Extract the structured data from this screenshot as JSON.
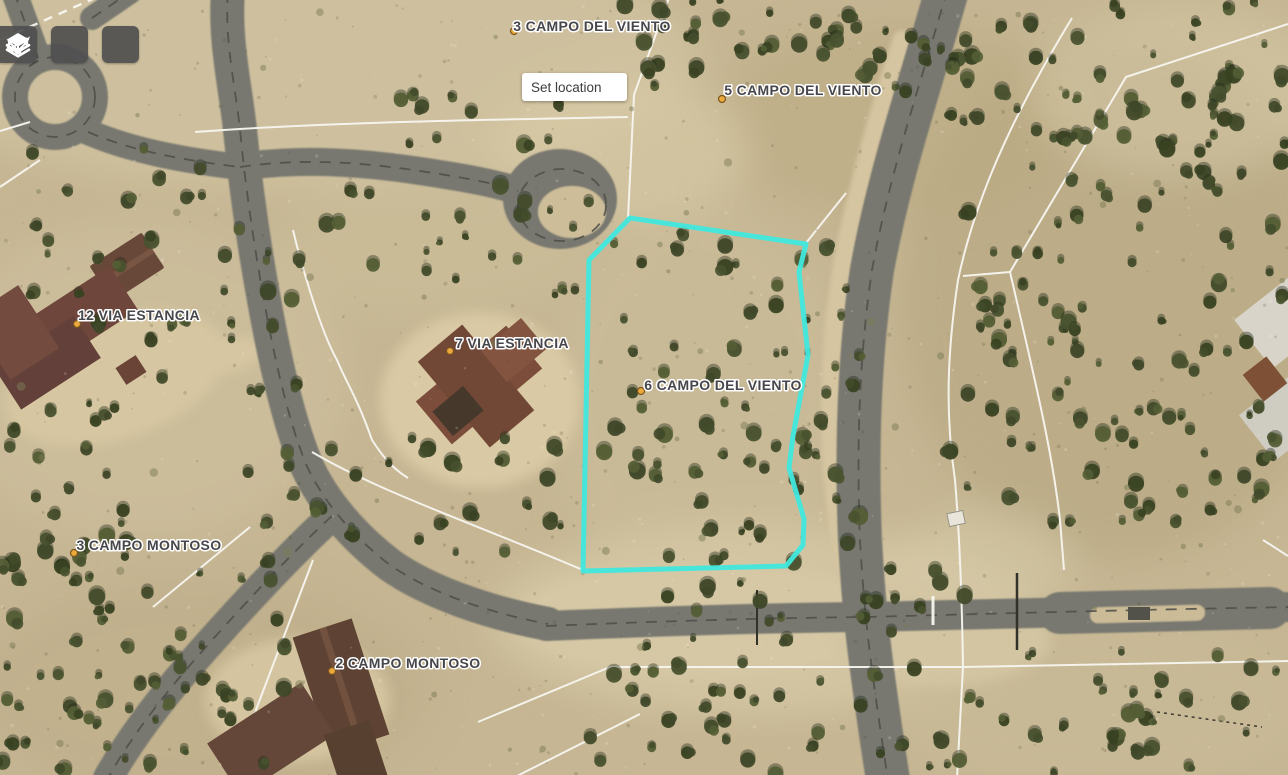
{
  "toolbar": {
    "buttons": [
      {
        "id": "layers",
        "icon": "layers-icon"
      },
      {
        "id": "directions",
        "icon": "route-arrows-icon"
      },
      {
        "id": "draw",
        "icon": "draw-ellipse-icon"
      }
    ]
  },
  "search": {
    "set_location_label": "Set location"
  },
  "map": {
    "type": "satellite-parcel-map",
    "highlight_color": "#40e8dd",
    "marker_color": "#eba93b",
    "marker_ring_color": "#7a5520",
    "label_color": "#47474b",
    "selected_parcel": "6 CAMPO DEL VIENTO",
    "selected_parcel_points": "630,218 806,244 799,272 808,355 793,436 789,468 804,519 803,545 786,566 583,571 589,260",
    "parcels": [
      {
        "label": "3 CAMPO DEL VIENTO"
      },
      {
        "label": "5 CAMPO DEL VIENTO"
      },
      {
        "label": "12 VIA ESTANCIA"
      },
      {
        "label": "7 VIA ESTANCIA"
      },
      {
        "label": "6 CAMPO DEL VIENTO"
      },
      {
        "label": "3 CAMPO MONTOSO"
      },
      {
        "label": "2 CAMPO MONTOSO"
      }
    ]
  }
}
